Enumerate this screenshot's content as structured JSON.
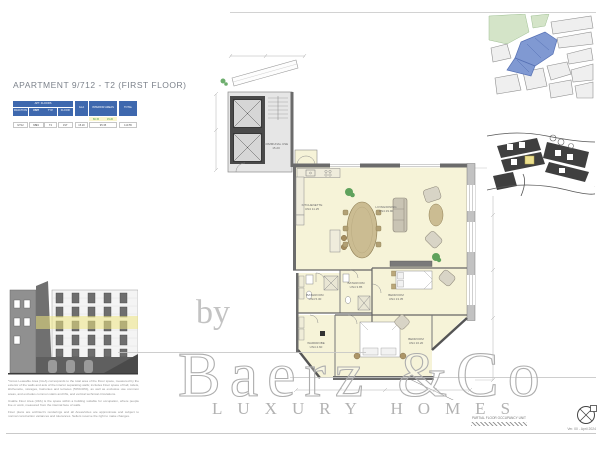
{
  "document": {
    "title": "APARTMENT 9/712 - T2 (FIRST FLOOR)",
    "occupancy_note": "PARTIAL FLOOR OCCUPANCY UNIT",
    "version": "Ver. 00 - April 2024"
  },
  "area_table": {
    "group_header": "APT. FLOORS",
    "columns": [
      "FRACTION",
      "UNIT",
      "TYP.",
      "FLOOR"
    ],
    "gla_header": "GLA",
    "interior_header": "INTERIOR AREAS",
    "total_header": "TOTAL",
    "interior_split_values": [
      "80.15",
      "15.20"
    ],
    "values": [
      "9/712",
      "UN4",
      "T2",
      "1ST",
      "15.20",
      "95.35",
      "110.55"
    ]
  },
  "floor_plan": {
    "rooms": {
      "communal": {
        "name": "COMMUNAL USE",
        "area": "15.20"
      },
      "kitchenette": {
        "name": "KITCHENETTE",
        "area": "UN4 11.25"
      },
      "living": {
        "name": "LIVING/DINING",
        "area": "UN4 29.90"
      },
      "bathroom_1": {
        "name": "BATHROOM",
        "area": "UN4 5.30"
      },
      "bathroom_2": {
        "name": "BATHROOM",
        "area": "UN4 3.85"
      },
      "bedroom_1": {
        "name": "BEDROOM",
        "area": "UN4 13.35"
      },
      "bedroom_2": {
        "name": "BEDROOM",
        "area": "UN4 16.20"
      },
      "wardrobe": {
        "name": "WARDROBE",
        "area": "UN4 4.60"
      }
    }
  },
  "watermark": {
    "by": "by",
    "brand": "Baerz &Co",
    "tagline": "LUXURY HOMES"
  },
  "disclaimer": {
    "p1": "*Gross Leasable Area (GLA) corresponds to the total area of the Floor space, measured by the exterior of the walls and axis of the interior separating walls; includes Floor space of hall, toilets, kitchenette, storages, balconies and terraces (50%/40%), as well as exclusive use common areas, and excludes common stairs and lifts, and vertical technical circulations.",
    "p2": "Usable Floor Area (UFA) is the space within a building suitable for occupation, where people live or work, measured from the internal face of walls.",
    "p3": "Floor plans are architect's renderings and all Areas/sizes are approximate and subject to normal construction variances and tolerances. Sellers reserve the right to make changes."
  },
  "colors": {
    "table_blue": "#3e68ae",
    "room_fill": "#f6f3d8",
    "floor_highlight": "#efe682",
    "map_highlight_blue": "#8099d2",
    "watermark_gray": "#c6c6c6"
  }
}
